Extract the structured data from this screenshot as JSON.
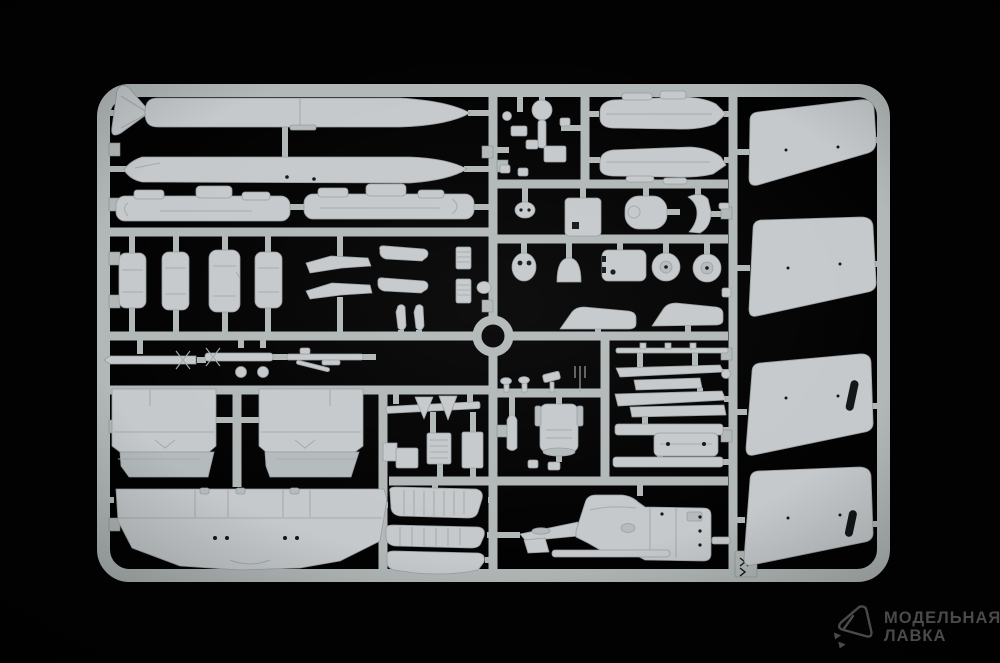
{
  "scene": {
    "description": "Photograph of a light-grey injection-moulded plastic model kit sprue with aircraft parts, shot on a black background",
    "background": "black"
  },
  "colors": {
    "background": "#020202",
    "sprue": "#b2b8b8",
    "sprue_shadow": "#878d8f",
    "part": "#c5c9cb",
    "part_shade": "#b5bbbd",
    "part_edge": "#979da0",
    "part_detail": "#a5abae",
    "hole": "#141617",
    "watermark": "#4a4a4a"
  },
  "watermark": {
    "line1": "МОДЕЛЬНАЯ",
    "line2": "ЛАВКА",
    "icon": "gem-plane-icon"
  },
  "sprue": {
    "frame": "rounded-rectangle runner frame with internal cross runners and centre ring",
    "parts": [
      "drop-tank-upper",
      "drop-tank-fins",
      "drop-tank-lower",
      "pod-half-left",
      "pod-half-right",
      "gear-door-1",
      "gear-door-2",
      "gear-door-3",
      "gear-door-4",
      "gear-door-pair",
      "rocket-with-fins-1",
      "rocket-with-fins-2",
      "boom-with-fittings",
      "ball-fittings",
      "teardrop-pair",
      "exhaust-pipe-1",
      "exhaust-pipe-2",
      "grille-strip-1",
      "grille-strip-2",
      "wing-upper-half-left",
      "wing-upper-half-right",
      "wing-lower-full-span",
      "small-fittings-cluster",
      "nacelle-half-upper",
      "nacelle-half-lower",
      "oval-fitting",
      "equipment-plate",
      "rounded-bulkhead",
      "c-bracket",
      "cockpit-oval",
      "dome-part",
      "bracket-plate",
      "wheel-1",
      "wheel-2",
      "windscreen-rail-left",
      "windscreen-rail-right",
      "control-knobs",
      "ejection-seat",
      "nose-cone-bullet",
      "pylon-rod",
      "pylon-strip-1",
      "pylon-strip-2",
      "pylon-strip-3",
      "pylon-strip-4",
      "bomb-rack",
      "pylon-strip-5",
      "linkage-with-arrowheads",
      "equipment-block-1",
      "equipment-block-2",
      "equipment-block-3",
      "ribbed-flap-1",
      "ribbed-flap-2",
      "canopy-base",
      "fuselage-half-with-nose-boom",
      "ventral-fin",
      "ventral-strip",
      "attachment-peg",
      "tailplane-panel-1",
      "tailplane-panel-2",
      "tailplane-panel-3",
      "tailplane-panel-4",
      "ejector-tab-with-arrows"
    ]
  }
}
